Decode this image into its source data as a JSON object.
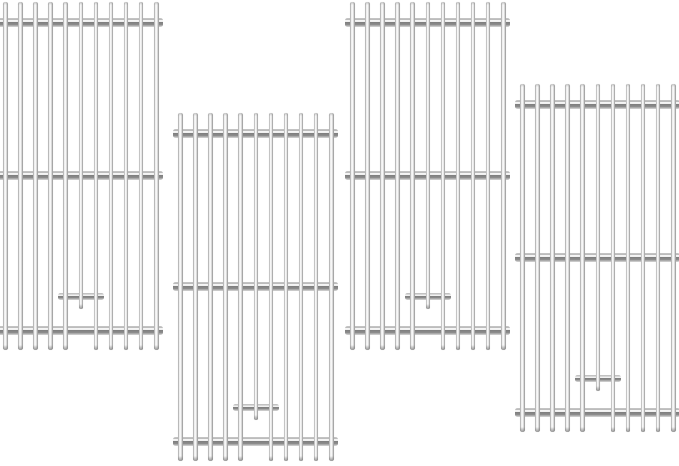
{
  "meta": {
    "type": "product-photo",
    "subject": "Four upright stainless steel grill cooking grate replacements on a plain white background, arranged in a staggered two-up two-down layout",
    "background_color": "#ffffff",
    "canvas": {
      "width": 679,
      "height": 466
    }
  },
  "palette": {
    "background": "#ffffff",
    "rod_highlight": "#fdfdfd",
    "rod_light": "#e3e3e3",
    "rod_mid": "#c6c6c6",
    "rod_dark": "#7d7d7d",
    "tip_shade": "#9b9b9b"
  },
  "grate_template": {
    "width": 165,
    "height": 352,
    "bar_count": 11,
    "bar_width": 4.6,
    "bar_spacing": 15.1,
    "bars_left_offset": 5,
    "bar_height": 348,
    "short_bar_index": 5,
    "short_bar_height": 307,
    "crossbars_y": [
      16,
      169,
      324
    ],
    "crossbar_height": 9,
    "bracket": {
      "x": 60,
      "y": 291,
      "width": 46,
      "height": 7
    }
  },
  "grates": [
    {
      "id": "grill-grate-1",
      "x": -2,
      "y": 2
    },
    {
      "id": "grill-grate-2",
      "x": 173,
      "y": 113
    },
    {
      "id": "grill-grate-3",
      "x": 345,
      "y": 2
    },
    {
      "id": "grill-grate-4",
      "x": 515,
      "y": 84
    }
  ]
}
